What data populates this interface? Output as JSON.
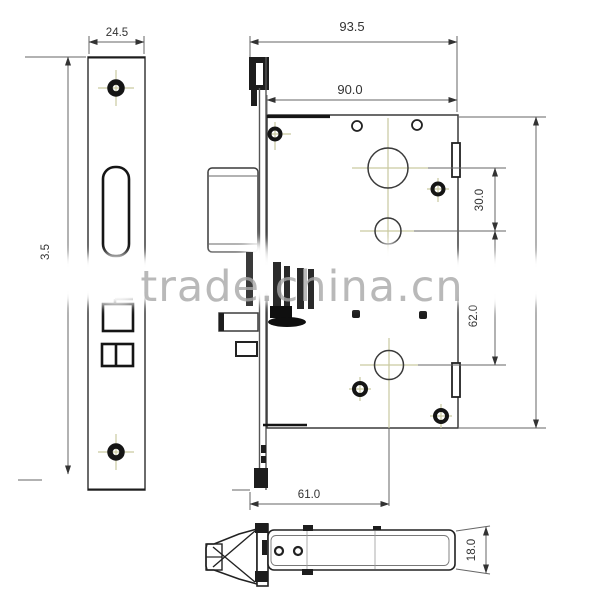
{
  "watermark": {
    "text": "trade.china.cn"
  },
  "dims": {
    "faceplate_width": "24.5",
    "faceplate_height": "3.5",
    "overall_depth": "93.5",
    "case_length": "90.0",
    "hub_spacing": "30.0",
    "cylinder_spacing": "62.0",
    "backset": "61.0",
    "latch_thickness": "18.0"
  },
  "colors": {
    "line": "#333333",
    "centerline": "#c9c9a0",
    "watermark_text": "#a8a8a8"
  }
}
